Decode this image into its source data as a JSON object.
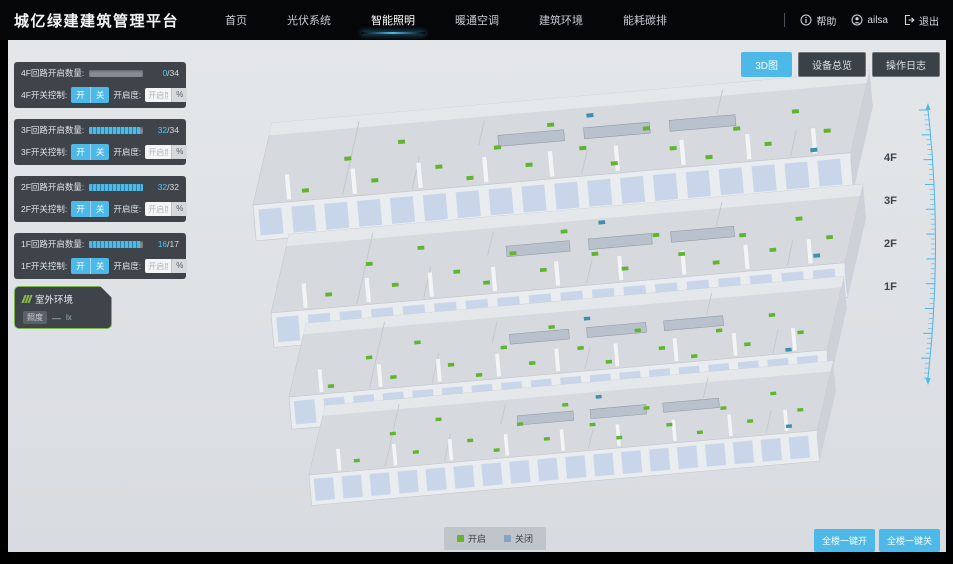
{
  "header": {
    "title": "城亿绿建建筑管理平台",
    "nav": [
      {
        "label": "首页",
        "active": false
      },
      {
        "label": "光伏系统",
        "active": false
      },
      {
        "label": "智能照明",
        "active": true
      },
      {
        "label": "暖通空调",
        "active": false
      },
      {
        "label": "建筑环境",
        "active": false
      },
      {
        "label": "能耗碳排",
        "active": false
      }
    ],
    "help_label": "帮助",
    "user_name": "ailsa",
    "logout_label": "退出"
  },
  "view_buttons": [
    {
      "label": "3D图",
      "active": true
    },
    {
      "label": "设备总览",
      "active": false
    },
    {
      "label": "操作日志",
      "active": false
    }
  ],
  "floor_panels": [
    {
      "count_label": "4F回路开启数量:",
      "count_on": "0",
      "count_total": "/34",
      "progress_pct": 0,
      "switch_label": "4F开关控制:",
      "on_label": "开",
      "off_label": "关",
      "openness_label": "开启度:",
      "openness_placeholder": "开启度",
      "percent_label": "%"
    },
    {
      "count_label": "3F回路开启数量:",
      "count_on": "32",
      "count_total": "/34",
      "progress_pct": 94,
      "switch_label": "3F开关控制:",
      "on_label": "开",
      "off_label": "关",
      "openness_label": "开启度:",
      "openness_placeholder": "开启度",
      "percent_label": "%"
    },
    {
      "count_label": "2F回路开启数量:",
      "count_on": "32",
      "count_total": "/32",
      "progress_pct": 100,
      "switch_label": "2F开关控制:",
      "on_label": "开",
      "off_label": "关",
      "openness_label": "开启度:",
      "openness_placeholder": "开启度",
      "percent_label": "%"
    },
    {
      "count_label": "1F回路开启数量:",
      "count_on": "16",
      "count_total": "/17",
      "progress_pct": 94,
      "switch_label": "1F开关控制:",
      "on_label": "开",
      "off_label": "关",
      "openness_label": "开启度:",
      "openness_placeholder": "开启度",
      "percent_label": "%"
    }
  ],
  "outdoor_panel": {
    "title": "室外环境",
    "illuminance_label": "照度",
    "illuminance_value": "—",
    "illuminance_unit": "lx"
  },
  "floor_axis_labels": [
    "4F",
    "3F",
    "2F",
    "1F"
  ],
  "legend": {
    "on_label": "开启",
    "off_label": "关闭",
    "on_color": "#67b42c",
    "off_color": "#85a3c4"
  },
  "bulk_buttons": [
    {
      "label": "全楼一键开"
    },
    {
      "label": "全楼一键关"
    }
  ],
  "colors": {
    "accent": "#4cb9e9",
    "ruler": "#49b6e8",
    "panel_bg": "#282e34",
    "green_marker": "#61b42e"
  }
}
